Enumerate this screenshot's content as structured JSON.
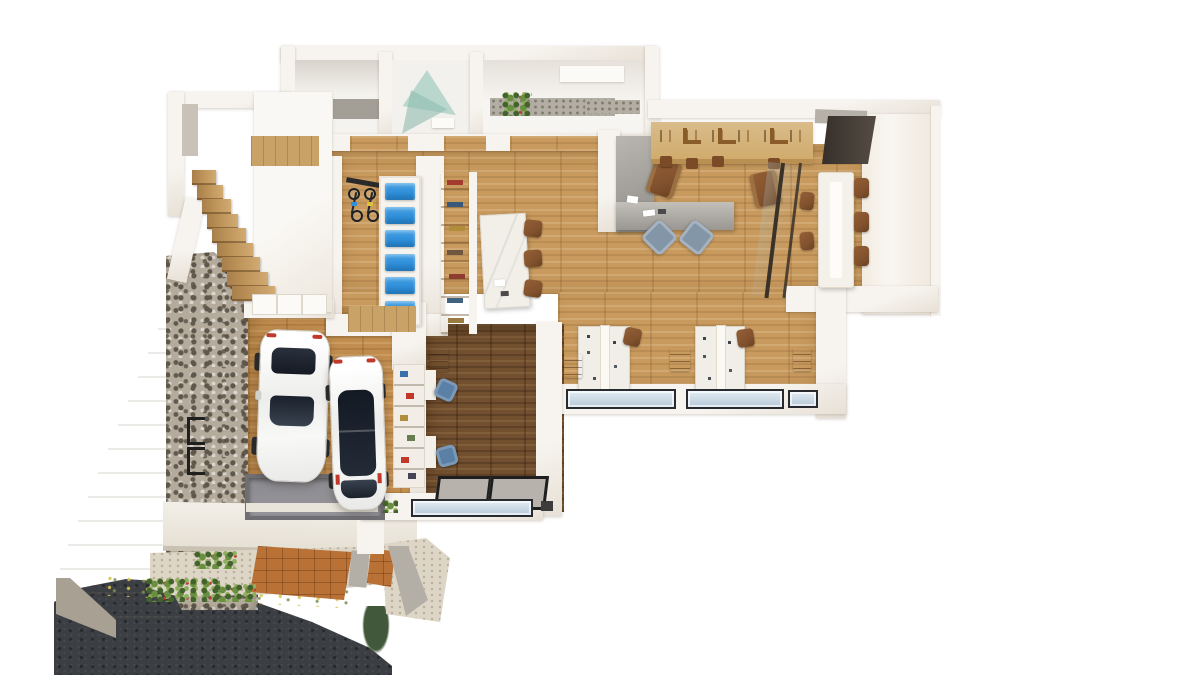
{
  "scene": {
    "title": "3D rendered floor plan, top-down view of an office/residence with garage",
    "view": "top-down architectural render on white background",
    "colors": {
      "page_bg": "#ffffff",
      "wall": "#f7f4ef",
      "wall_shade": "#e7e0d6",
      "wall_edge": "#d3ccc1",
      "wood": "#c89a5e",
      "wood_garage": "#c28e4f",
      "wood_dark": "#72502f",
      "wood_stair": "#bb9157",
      "wood_shelf": "#d9bc8a",
      "wood_lintel": "#c8a267",
      "marble": "#f2efe9",
      "counter_gray": "#a3a09b",
      "stone_base": "#b5ab9c",
      "stone_dark": "#5e574b",
      "beige_wall": "#d8d1c3",
      "beige_face": "#a8a193",
      "asphalt": "#3b3e43",
      "terracotta": "#b97135",
      "curb_gray": "#b4afa6",
      "gravel": "#ddd6c6",
      "glass_blue": "#c3d5e2",
      "glass_teal": "#aed2c6",
      "accent_blue": "#2f8fd9",
      "chair_brown": "#82522e",
      "chair_blue": "#8396a8",
      "task_chair_blue": "#5b80a6",
      "car_white": "#f4f4f2",
      "car_glass": "#1d242e",
      "red_accent": "#c0392b",
      "green_plant": "#69903f",
      "green_dark": "#43622c",
      "pit_gray": "#95949a",
      "mat_gray": "#b7b3ac",
      "frame_black": "#1f1f1f"
    },
    "counts": {
      "stair_steps": 9,
      "locker_bins": 6,
      "bicycles": 3
    },
    "bike_accents": [
      "#2f8fd9",
      "#e0c13c",
      "#c0392b"
    ]
  },
  "areas": [
    {
      "name": "back-room-storage",
      "floor": "white"
    },
    {
      "name": "back-room-shower",
      "floor": "teal-glass"
    },
    {
      "name": "back-room-washroom",
      "floor": "white"
    },
    {
      "name": "stairwell",
      "floor": "wood-steps"
    },
    {
      "name": "gym-locker-area",
      "floor": "wood"
    },
    {
      "name": "open-office",
      "floor": "wood"
    },
    {
      "name": "kitchen-bar",
      "floor": "wood"
    },
    {
      "name": "glass-meeting-room",
      "floor": "wood"
    },
    {
      "name": "workstation-zone",
      "floor": "wood"
    },
    {
      "name": "garage",
      "floor": "wood"
    },
    {
      "name": "entry-den",
      "floor": "dark-wood"
    },
    {
      "name": "driveway",
      "floor": "concrete"
    },
    {
      "name": "entry-deck",
      "floor": "terracotta-tile"
    },
    {
      "name": "street",
      "floor": "asphalt"
    }
  ],
  "furniture": [
    {
      "name": "white-car",
      "count": 2
    },
    {
      "name": "bicycle-rack-bike",
      "count": 3
    },
    {
      "name": "blue-locker-bin",
      "count": 6
    },
    {
      "name": "wood-stair-step",
      "count": 9
    },
    {
      "name": "marble-table",
      "count": 1
    },
    {
      "name": "dining-chair-brown",
      "count": 3
    },
    {
      "name": "reception-counter-L",
      "count": 1
    },
    {
      "name": "lounge-chair-brown",
      "count": 2
    },
    {
      "name": "armchair-blue",
      "count": 2
    },
    {
      "name": "meeting-table",
      "count": 1
    },
    {
      "name": "meeting-chair-brown",
      "count": 5
    },
    {
      "name": "workstation-pod",
      "count": 2
    },
    {
      "name": "task-chair-brown",
      "count": 2
    },
    {
      "name": "task-chair-blue",
      "count": 2
    },
    {
      "name": "storage-cabinet-brown",
      "count": 4
    },
    {
      "name": "garage-shelving",
      "count": 1
    },
    {
      "name": "service-pit",
      "count": 1
    },
    {
      "name": "appliance-box",
      "count": 3
    },
    {
      "name": "entry-mat",
      "count": 2
    },
    {
      "name": "exterior-window",
      "count": 4
    },
    {
      "name": "plant",
      "count": 5
    }
  ]
}
